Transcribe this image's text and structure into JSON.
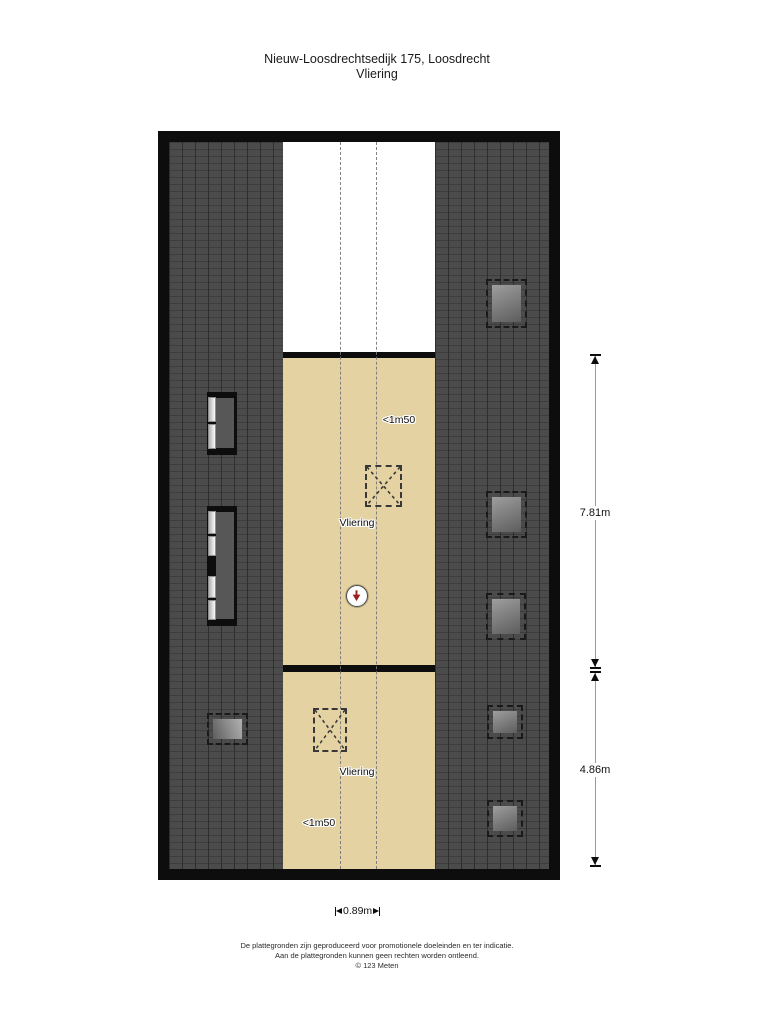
{
  "page": {
    "title_line1": "Nieuw-Loosdrechtsedijk 175, Loosdrecht",
    "title_line2": "Vliering"
  },
  "floorplan": {
    "upper_room": {
      "label": "Vliering",
      "height_note": "<1m50"
    },
    "lower_room": {
      "label": "Vliering",
      "height_note": "<1m50"
    }
  },
  "dimensions": {
    "right_upper": "7.81m",
    "right_lower": "4.86m",
    "bottom": "0.89m"
  },
  "footer": {
    "line1": "De plattegronden zijn geproduceerd voor promotionele doeleinden en ter indicatie.",
    "line2": "Aan de plattegronden kunnen geen rechten worden ontleend.",
    "line3": "© 123 Meten"
  },
  "colors": {
    "beige": "#e4d2a2",
    "roof-dark": "#4b4b4b",
    "wall-black": "#0d0d0d",
    "compass-red": "#9e1f1f",
    "dash-gray": "#777777"
  }
}
